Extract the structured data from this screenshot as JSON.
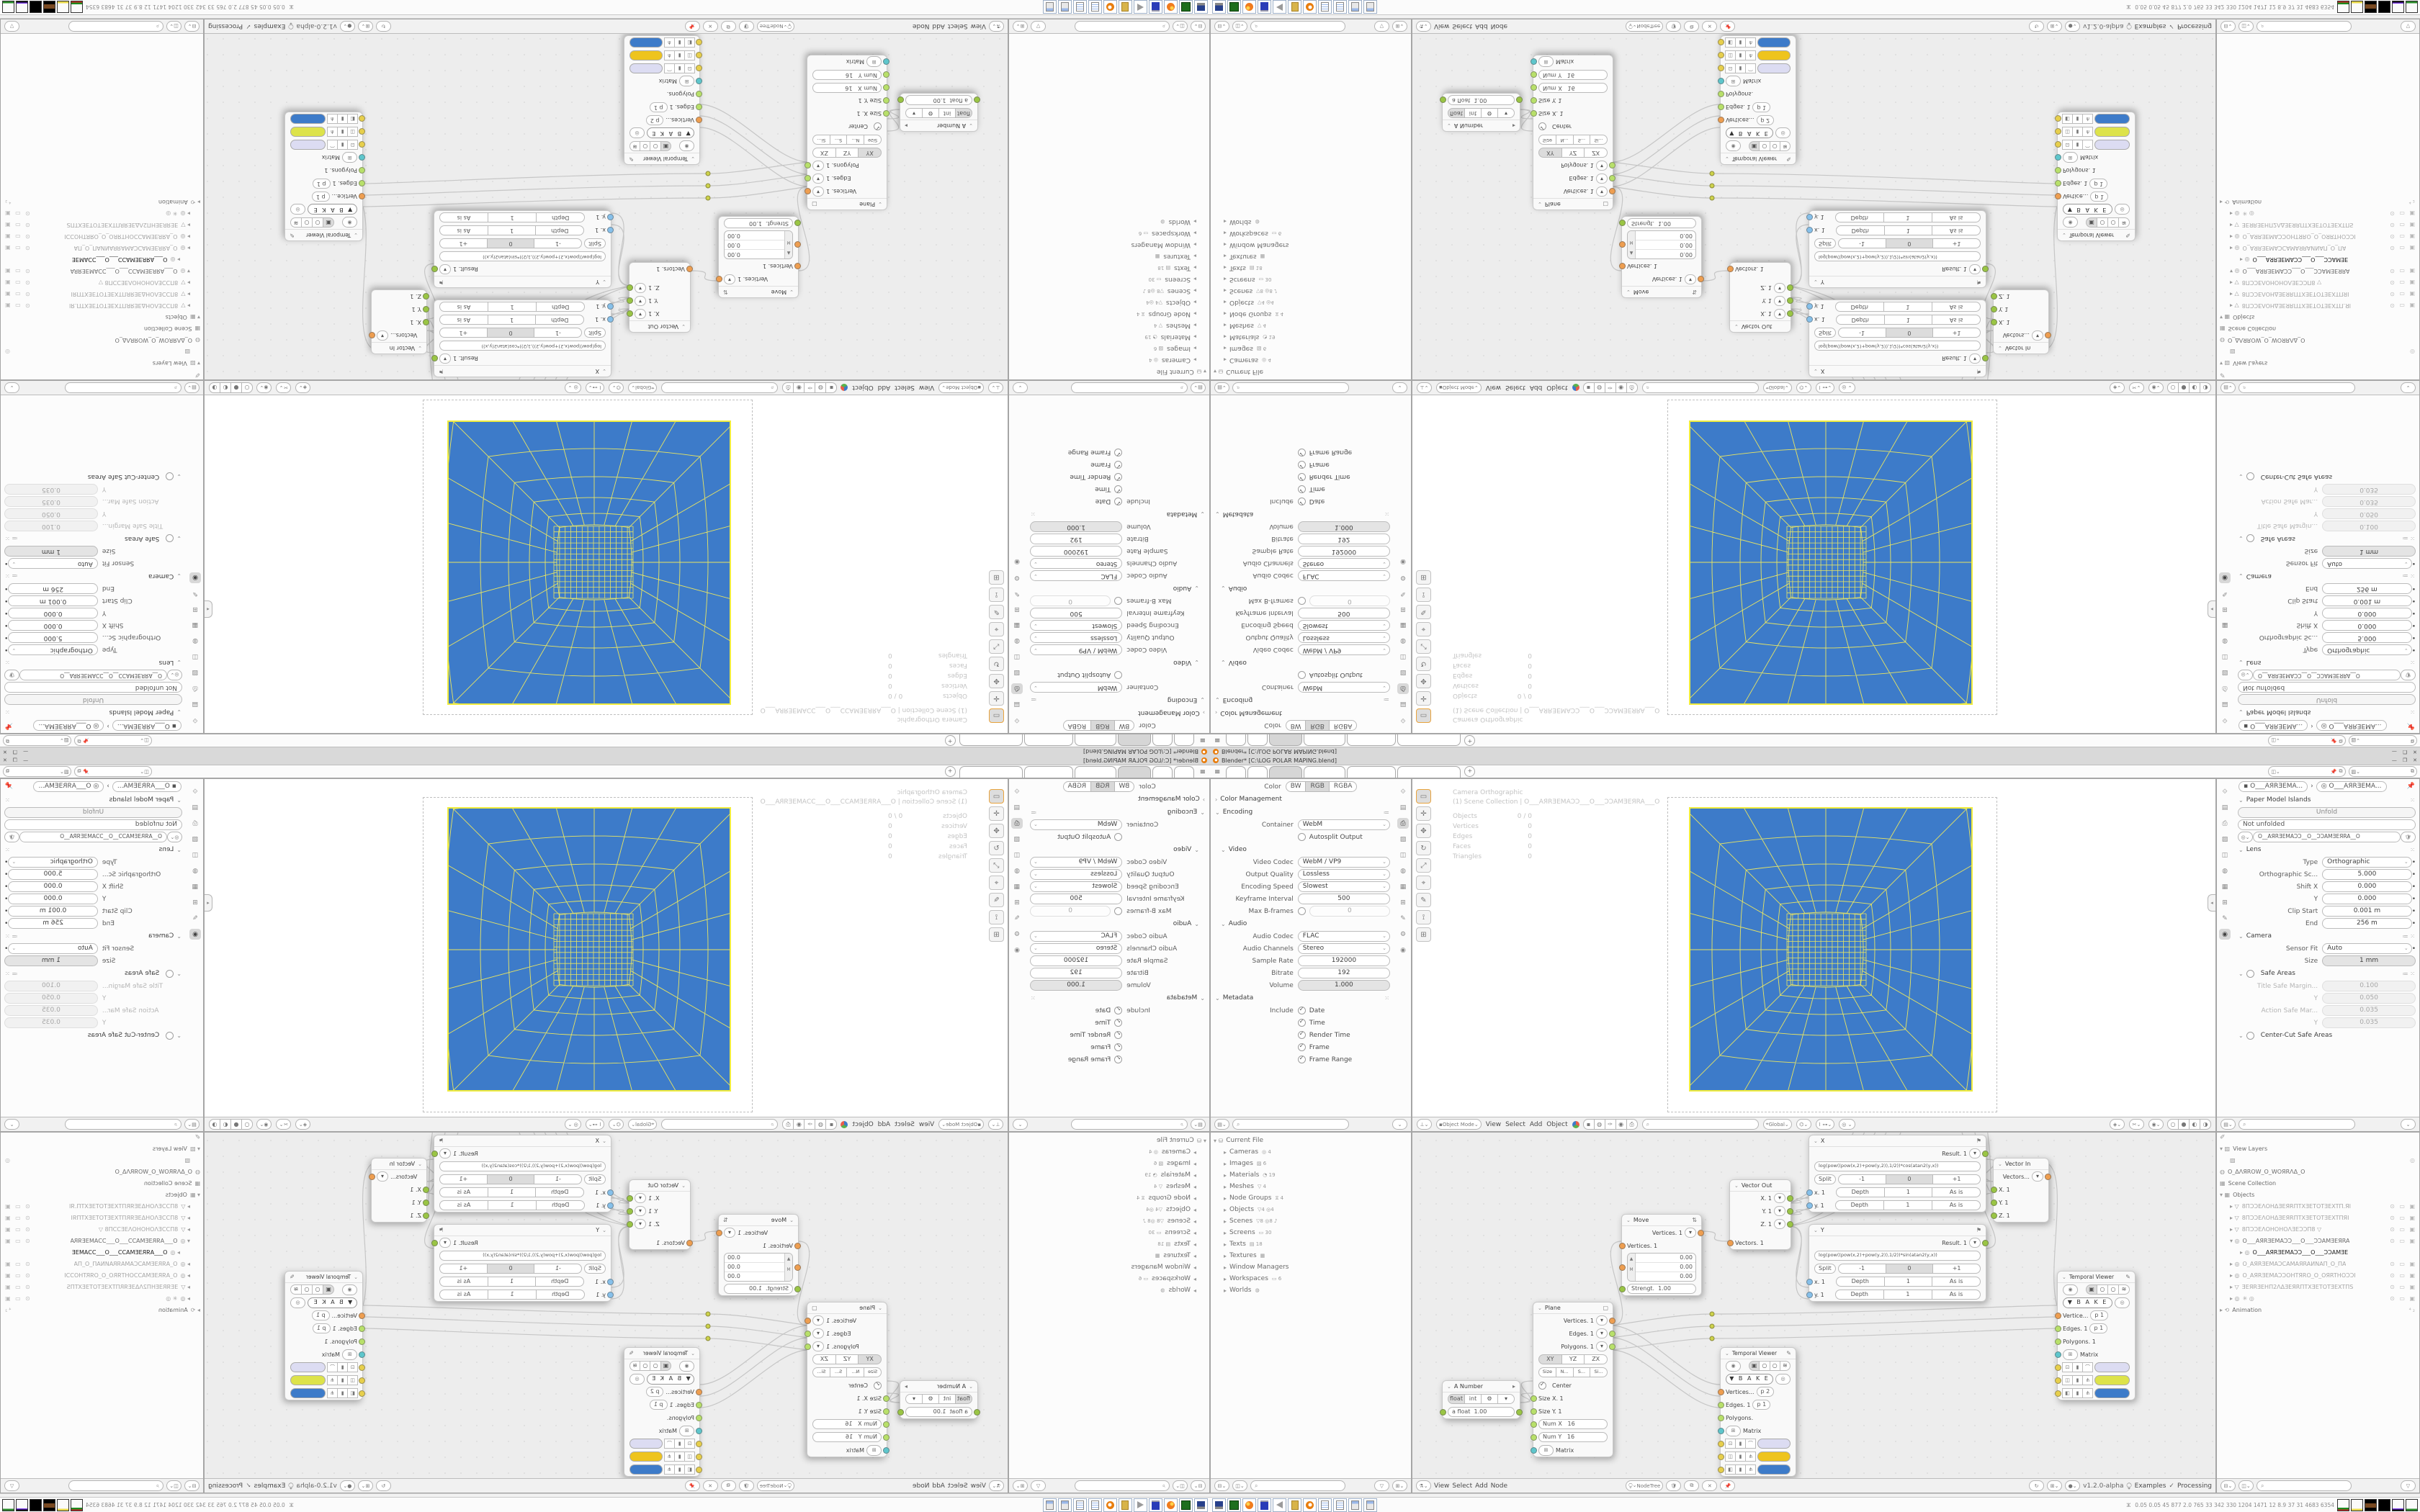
{
  "titlebar": {
    "title": "Blender*  [C:\\LOG POLAR MAPING.blend]",
    "min": "—",
    "restore": "❐",
    "close": "✕"
  },
  "topbar": {
    "add_tab": "+",
    "scene_value": "",
    "viewlayer_value": ""
  },
  "props_output": {
    "color_label": "Color",
    "color_segs": [
      "BW",
      "RGB",
      "RGBA"
    ],
    "rows": [
      {
        "label": "Color Management"
      },
      {
        "label": "Encoding"
      },
      {
        "label": "Container",
        "value": "WebM"
      },
      {
        "label": "Autosplit Output"
      },
      {
        "label": "Video"
      },
      {
        "label": "Video Codec",
        "value": "WebM / VP9"
      },
      {
        "label": "Output Quality",
        "value": "Lossless"
      },
      {
        "label": "Encoding Speed",
        "value": "Slowest"
      },
      {
        "label": "Keyframe Interval",
        "value": "500"
      },
      {
        "label": "Max B-frames",
        "value": "0"
      },
      {
        "label": "Audio"
      },
      {
        "label": "Audio Codec",
        "value": "FLAC"
      },
      {
        "label": "Audio Channels",
        "value": "Stereo"
      },
      {
        "label": "Sample Rate",
        "value": "192000"
      },
      {
        "label": "Bitrate",
        "value": "192"
      },
      {
        "label": "Volume",
        "value": "1.000"
      },
      {
        "label": "Metadata"
      },
      {
        "label": "Include",
        "value": "Date"
      },
      {
        "value": "Time"
      },
      {
        "value": "Render Time"
      },
      {
        "value": "Frame"
      },
      {
        "value": "Frame Range"
      }
    ]
  },
  "viewport": {
    "mode": "Object Mode",
    "menus": [
      "View",
      "Select",
      "Add",
      "Object"
    ],
    "orientation": "Global",
    "overlay_line1": "Camera Orthographic",
    "overlay_line2": "(1) Scene Collection | O___AЯRƎEMAƆƆ___O___ƆƆAMƎEЯRA___O",
    "stats": [
      {
        "k": "Objects",
        "v": "0 / 0"
      },
      {
        "k": "Vertices",
        "v": "0"
      },
      {
        "k": "Edges",
        "v": "0"
      },
      {
        "k": "Faces",
        "v": "0"
      },
      {
        "k": "Triangles",
        "v": "0"
      }
    ],
    "plane_color": "#3d7bc9",
    "wire_color": "#e9e561",
    "ntab": "◂"
  },
  "props_camera": {
    "breadcrumb_a": "O___AЯRƎEMA...",
    "breadcrumb_b": "O___AЯRƎEMA...",
    "rows": [
      {
        "label": "Paper Model Islands"
      },
      {
        "value": "Unfold"
      },
      {
        "value": "Not unfolded"
      },
      {
        "value": "O__AЯRƎEMAƆƆ__O__ƆƆAMƎEЯRA__O"
      },
      {
        "label": "Lens"
      },
      {
        "label": "Type",
        "value": "Orthographic"
      },
      {
        "label": "Orthographic Sc...",
        "value": "5.000"
      },
      {
        "label": "Shift X",
        "value": "0.000"
      },
      {
        "label": "Y",
        "value": "0.000"
      },
      {
        "label": "Clip Start",
        "value": "0.001 m"
      },
      {
        "label": "End",
        "value": "256 m"
      },
      {
        "label": "Camera"
      },
      {
        "label": "Sensor Fit",
        "value": "Auto"
      },
      {
        "label": "Size",
        "value": "1 mm"
      },
      {
        "label": "Safe Areas"
      },
      {
        "label": "Title Safe Margin...",
        "value": "0.100"
      },
      {
        "label": "Y",
        "value": "0.050"
      },
      {
        "label": "Action Safe Mar...",
        "value": "0.035"
      },
      {
        "label": "Y",
        "value": "0.035"
      },
      {
        "label": "Center-Cut Safe Areas"
      }
    ]
  },
  "outliner_file": {
    "root": "Current File",
    "rows": [
      {
        "label": "Cameras",
        "badge": "◎ 4"
      },
      {
        "label": "Images",
        "badge": "▨ 6"
      },
      {
        "label": "Materials",
        "badge": "◔ 19"
      },
      {
        "label": "Meshes",
        "badge": "▽ 4"
      },
      {
        "label": "Node Groups",
        "badge": "⧖ 4"
      },
      {
        "label": "Objects",
        "badge": "▽4 ◎4"
      },
      {
        "label": "Scenes",
        "badge": "▽8 ◎8 ♪"
      },
      {
        "label": "Screens",
        "badge": "▭ 30"
      },
      {
        "label": "Texts",
        "badge": "▤ 18"
      },
      {
        "label": "Textures",
        "badge": "▦"
      },
      {
        "label": "Window Managers",
        "badge": ""
      },
      {
        "label": "Workspaces",
        "badge": "▭ 6"
      },
      {
        "label": "Worlds",
        "badge": "◍"
      }
    ]
  },
  "outliner_scene": {
    "corner_icon": "✐",
    "rows": [
      {
        "cls": "orow",
        "icon": "▾ ▨",
        "label": "View Layers",
        "right": ""
      },
      {
        "cls": "orow ind1",
        "icon": "▨",
        "label": "",
        "right": "◎"
      },
      {
        "cls": "orow",
        "icon": "◍",
        "label": "O_ΔΛЯROW_O_WOЯRΛΔ_O",
        "right": ""
      },
      {
        "cls": "orow",
        "icon": "▦",
        "label": "Scene Collection",
        "right": ""
      },
      {
        "cls": "orow",
        "icon": "▾ ▦",
        "label": "Objects",
        "right": ""
      },
      {
        "cls": "orow ind1 dim",
        "icon": "▸ ▽",
        "label": "8ПƆƆEΛOHΔƎEЯRПTXƎETOTƎEXTП.ЯI",
        "right": "⊙ ▭ ▣"
      },
      {
        "cls": "orow ind1 dim",
        "icon": "▸ ▽",
        "label": "8ПƆƆEΛOHΔƎEЯRПTXƎETOTƎEXTПЯI",
        "right": "⊙ ▭ ▣"
      },
      {
        "cls": "orow ind1 dim",
        "icon": "▸ ▽",
        "label": "8ПƆƆEΛOHOHOΛƎEƆƆП8      ▽",
        "right": "⊙ ▭ ▣"
      },
      {
        "cls": "orow ind1",
        "icon": "▾ ◎",
        "label": "O___AЯRƎEMAƆƆ___O___ƆƆAMƎEЯRA",
        "right": "⊙ ▭ ▣"
      },
      {
        "cls": "orow ind2 dark",
        "icon": "▸ ◎",
        "label": "O___AЯRƎEMAƆƆ___O___ƆƆAMƎE",
        "right": ""
      },
      {
        "cls": "orow ind1 dim",
        "icon": "▸ ◎",
        "label": "O_AЯRƎEMAƆCAMAЯRAИNAП_O_ПA",
        "right": "⊙ ▭ ▣"
      },
      {
        "cls": "orow ind1 dim",
        "icon": "▸ ◎",
        "label": "O_AЯRƎEMAƆƆOHTЯRO_O_OЯRTHOƆƆI",
        "right": "⊙ ▭ ▣"
      },
      {
        "cls": "orow ind1 dim",
        "icon": "▸ ▽",
        "label": "ƎEЯRƎEHП2ΛΔƎEЯRПTXƎETOTƎEXTПЅ",
        "right": "⊙ ▭ ▣"
      },
      {
        "cls": "orow ind1 dim",
        "icon": "▸ ◎",
        "label": "✳     ◎",
        "right": "⊙ ▭ ▣"
      },
      {
        "cls": "orow",
        "icon": "▸ ⟲",
        "label": "Animation",
        "right": "⁴₂"
      }
    ]
  },
  "node_editor": {
    "menus": [
      "View",
      "Select",
      "Add",
      "Node"
    ],
    "tree_name": "NodeTree",
    "version": "v1.2.0-alpha",
    "examples": "Examples",
    "processing": "Processing",
    "check": "✓",
    "nodes": {
      "a_number": {
        "title": "A Number",
        "segs": [
          "float",
          "int",
          "⚙",
          "▾"
        ],
        "out_label": "a float",
        "out_value": "1.00"
      },
      "plane": {
        "title": "Plane",
        "outs": [
          "Vertices. 1",
          "Edges. 1",
          "Polygons. 1"
        ],
        "axis_segs": [
          "XY",
          "YZ",
          "ZX"
        ],
        "size_segs": [
          "Size",
          "N...",
          "S...",
          "Si..."
        ],
        "center": "Center",
        "in1": "Size X. 1",
        "in2": "Size Y. 1",
        "in3": "Num X",
        "in3v": "16",
        "in4": "Num Y",
        "in4v": "16",
        "in5": "Matrix"
      },
      "move": {
        "title": "Move",
        "out": "Vertices. 1",
        "in1": "Vertices. 1",
        "vec": [
          "0.00",
          "0.00",
          "0.00"
        ],
        "vcol": [
          "▲",
          "M",
          ""
        ],
        "strength_label": "Strengt.",
        "strength_value": "1.00"
      },
      "vector_out": {
        "title": "Vector Out",
        "outs": [
          "X. 1",
          "Y. 1",
          "Z. 1"
        ],
        "in1": "Vectors. 1"
      },
      "vector_in": {
        "title": "Vector In",
        "out": "Vectors...",
        "ins": [
          "X. 1",
          "Y. 1",
          "Z. 1"
        ]
      },
      "x": {
        "title": "X",
        "result": "Result. 1",
        "formula": "log(pow((pow(x,2)+pow(y,2)),1/2))*cos(atan2(y,x))",
        "split": "Split",
        "m1": "-1",
        "z": "0",
        "p1": "+1",
        "inx": "x. 1",
        "iny": "y. 1",
        "depth": "Depth",
        "one": "1",
        "asis": "As is"
      },
      "y": {
        "title": "Y",
        "result": "Result. 1",
        "formula": "log(pow((pow(x,2)+pow(y,2)),1/2))*sin(atan2(y,x))",
        "split": "Split",
        "m1": "-1",
        "z": "0",
        "p1": "+1",
        "inx": "x. 1",
        "iny": "y. 1",
        "depth": "Depth",
        "one": "1",
        "asis": "As is"
      },
      "tv1": {
        "title": "Temporal Viewer",
        "bake": "B A K E",
        "r1": "Vertices...",
        "r1c": "p   2",
        "r2": "Edges. 1",
        "r2c": "p   1",
        "r3": "Polygons.",
        "r4": "Matrix",
        "sw1": "#dcdcf2",
        "sw2": "#eec41e",
        "sw3": "#3d7bc9"
      },
      "tv2": {
        "title": "Temporal Viewer",
        "bake": "B A K E",
        "r1": "Vertice...",
        "r1c": "p   1",
        "r2": "Edges. 1",
        "r2c": "p   1",
        "r3": "Polygons. 1",
        "r4": "Matrix",
        "sw1": "#dcdcf2",
        "sw2": "#dde34a",
        "sw3": "#3d7bc9"
      }
    }
  },
  "taskbar": {
    "stats_person_icon": "ⵣ",
    "stats": "0.05 0.05   45   877   2.0   765   33   342   330   1204 1471   12   8.9   37   31   4683 6354"
  },
  "icons": {
    "props_tabs": [
      "⟐",
      "▤",
      "⎙",
      "▨",
      "◫",
      "◍",
      "▦",
      "⊞",
      "✎",
      "⚙",
      "◉"
    ],
    "vp_tools": [
      "▭",
      "✛",
      "✥",
      "↻",
      "⤢",
      "⌖",
      "✎",
      "⟟",
      "⊞"
    ],
    "shading": [
      "○",
      "●",
      "◐",
      "◑"
    ]
  }
}
